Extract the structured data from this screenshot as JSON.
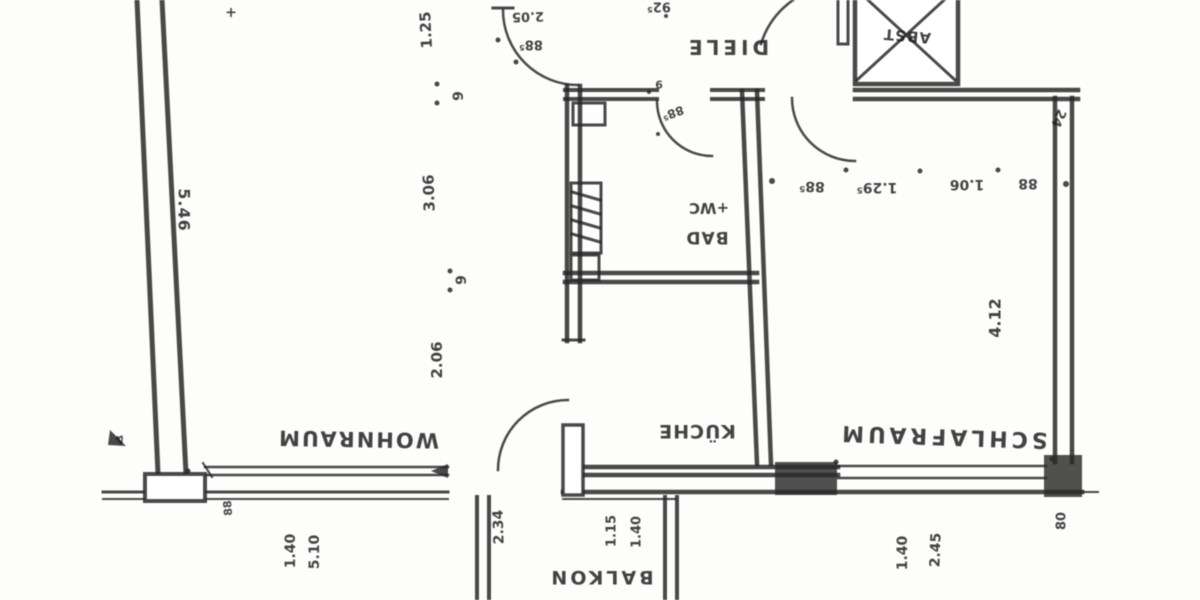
{
  "plan_type": "apartment floor plan (scanned, shown rotated 180°)",
  "rooms": {
    "wohnraum": "WOHNRAUM",
    "kueche": "KÜCHE",
    "schlafraum": "SCHLAFRAUM",
    "diele": "DIELE",
    "bad": "BAD",
    "wc": "+WC",
    "abst": "ABST",
    "balkon": "BALKON"
  },
  "dims": {
    "depth_left": "5.46",
    "depth_right": "4.12",
    "chain": [
      "88⁵",
      "1.29⁵",
      "1.06",
      "88"
    ],
    "vchain": [
      "1.25",
      "9",
      "3.06",
      "9",
      "2.06"
    ],
    "entry_door_width": "88⁵",
    "entry_clear": "2.05",
    "entry_len": "92⁵",
    "bad_door_width": "88⁵",
    "bad_door_extra": "9",
    "wall_thk": "24",
    "win_wohn": [
      "5.10",
      "1.40"
    ],
    "win_kueche": [
      "1.15",
      "1.40"
    ],
    "win_schlaf": [
      "2.45",
      "1.40"
    ],
    "balkon_door": "2.34",
    "pier": "80",
    "small88": "88",
    "plus_mark": "+",
    "frag": "4"
  },
  "ink_color": "#2e2e2e"
}
